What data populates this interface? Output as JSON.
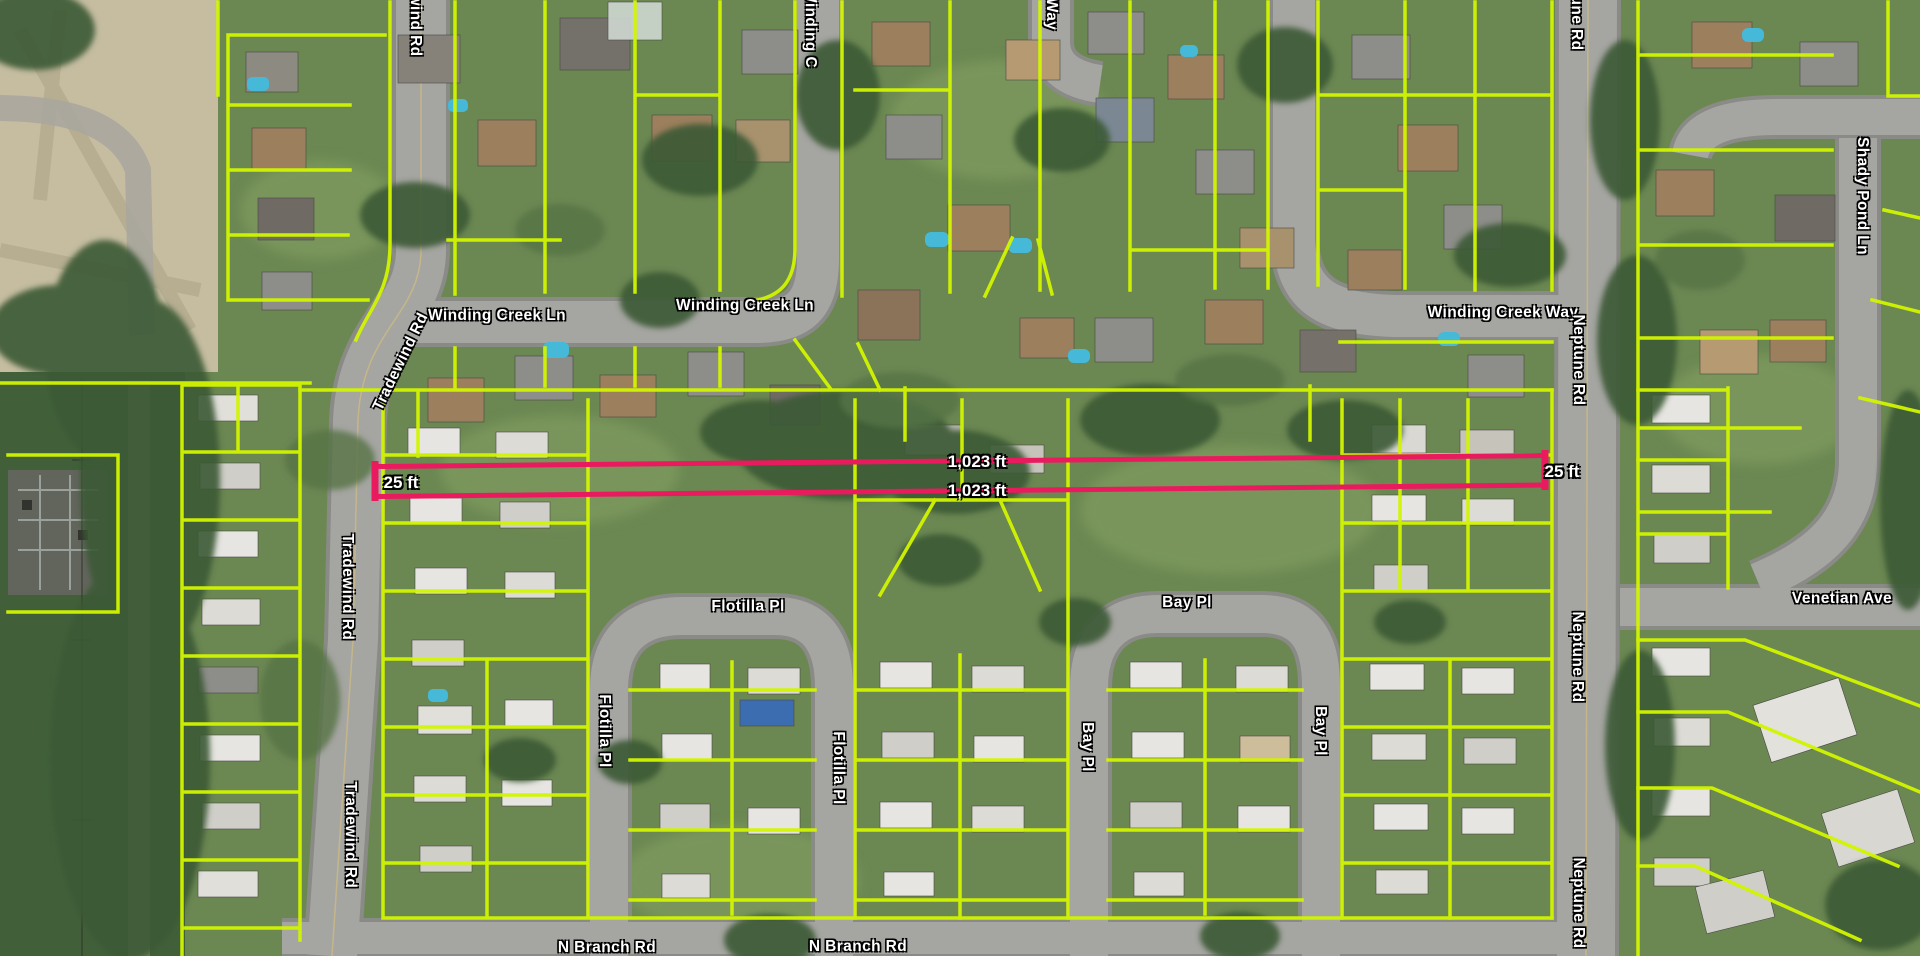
{
  "map": {
    "street_labels": [
      {
        "text": "wind Rd"
      },
      {
        "text": "Winding Creek Ln"
      },
      {
        "text": "Winding Creek Ln"
      },
      {
        "text": "Winding C"
      },
      {
        "text": "Way"
      },
      {
        "text": "une Rd"
      },
      {
        "text": "Shady Pond Ln"
      },
      {
        "text": "Winding Creek Way"
      },
      {
        "text": "Neptune Rd"
      },
      {
        "text": "Tradewind Rd"
      },
      {
        "text": "Tradewind Rd"
      },
      {
        "text": "Tradewind Rd"
      },
      {
        "text": "Flotilla Pl"
      },
      {
        "text": "Flotilla Pl"
      },
      {
        "text": "Flotilla Pl"
      },
      {
        "text": "Bay Pl"
      },
      {
        "text": "Bay Pl"
      },
      {
        "text": "Bay Pl"
      },
      {
        "text": "Venetian Ave"
      },
      {
        "text": "Neptune Rd"
      },
      {
        "text": "Neptune Rd"
      },
      {
        "text": "N Branch Rd"
      },
      {
        "text": "N Branch Rd"
      }
    ],
    "measurement": {
      "labels": [
        {
          "text": "1,023 ft"
        },
        {
          "text": "1,023 ft"
        },
        {
          "text": "25 ft"
        },
        {
          "text": "25 ft"
        }
      ]
    },
    "colors": {
      "parcel_line": "#d2f500",
      "measure_line": "#ea1a5f",
      "road": "#a5a5a1",
      "label_text": "#ffffff"
    }
  }
}
